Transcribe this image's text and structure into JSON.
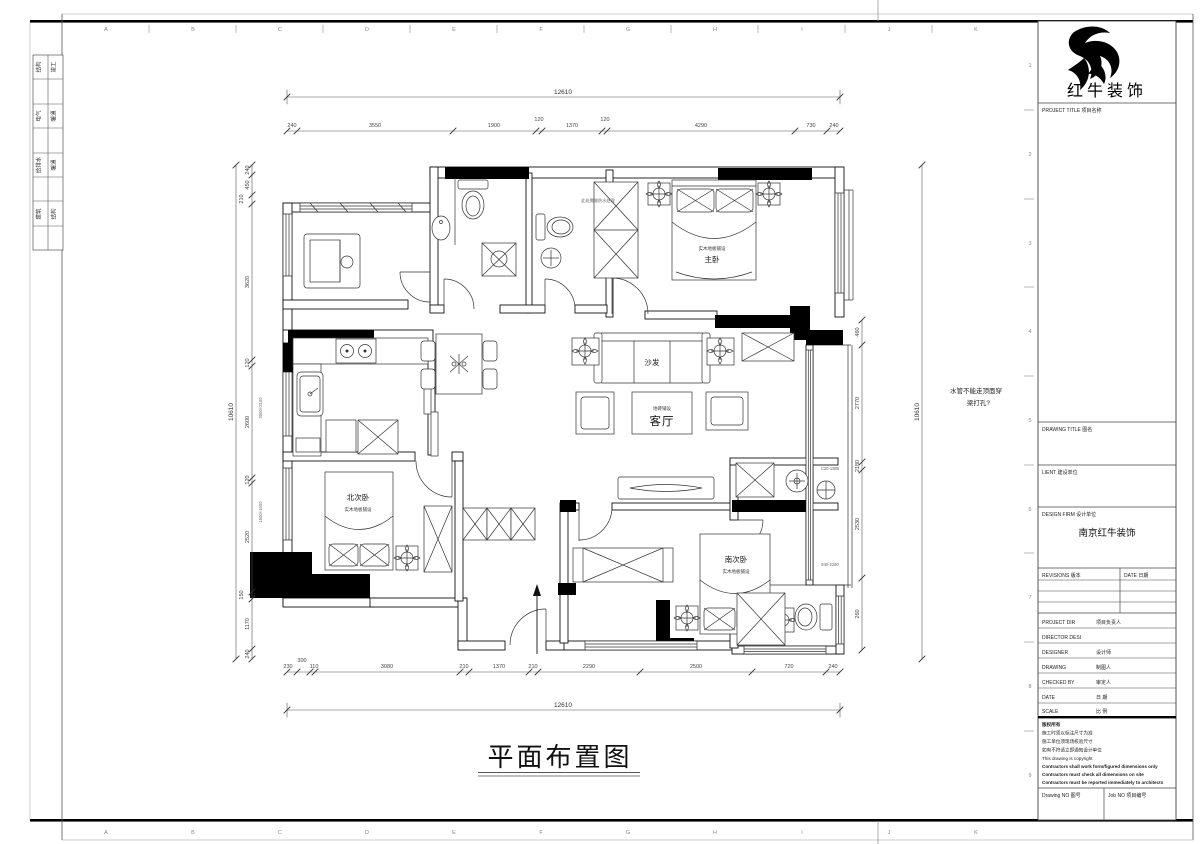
{
  "sheet": {
    "grid_letters": [
      "A",
      "B",
      "C",
      "D",
      "E",
      "F",
      "G",
      "H",
      "I",
      "J",
      "K"
    ],
    "grid_numbers": [
      "1",
      "2",
      "3",
      "4",
      "5",
      "6",
      "7",
      "8",
      "9"
    ],
    "signoff_rows": [
      {
        "a": "结构",
        "b": "竣工"
      },
      {
        "a": "电气",
        "b": "暖通"
      },
      {
        "a": "给排水",
        "b": "暖通"
      },
      {
        "a": "建筑",
        "b": "结构"
      }
    ]
  },
  "plan": {
    "title": "平面布置图",
    "note_line1": "水管不能走顶面穿",
    "note_line2": "梁打孔?",
    "waterproof_note": "此处需做防水处理",
    "rooms": {
      "living": "客厅",
      "living_sub": "地砖铺设",
      "sofa": "沙发",
      "master": "主卧",
      "master_sub": "实木地板铺设",
      "north": "北次卧",
      "north_sub": "实木地板铺设",
      "south": "南次卧",
      "south_sub": "实木地板铺设"
    },
    "window_tags": [
      "2000×2100",
      "1500×1500",
      "C20-1985",
      "940-2290"
    ],
    "dims": {
      "top_total": "12610",
      "bottom_total": "12610",
      "left_total": "10610",
      "right_total": "10610",
      "top": [
        "240",
        "3550",
        "1900",
        "120",
        "1370",
        "120",
        "4290",
        "730",
        "240"
      ],
      "bottom": [
        "230",
        "300",
        "110",
        "3080",
        "210",
        "1370",
        "210",
        "2290",
        "2500",
        "720",
        "240"
      ],
      "left": [
        "240",
        "450",
        "210",
        "3620",
        "120",
        "2600",
        "120",
        "2520",
        "150",
        "1170",
        "240"
      ],
      "right": [
        "460",
        "2770",
        "2180",
        "2530",
        "260"
      ]
    }
  },
  "titleblock": {
    "brand": "红牛装饰",
    "project_title": "PROJECT TITLE  项目名称",
    "drawing_title": "DRAWING TITLE  图名",
    "client": "LIENT  建设单位",
    "design_firm_label": "DESIGN FIRM  设计单位",
    "design_firm": "南京红牛装饰",
    "revisions": "REVISIONS  版本",
    "date_col": "DATE  日期",
    "rows": [
      {
        "en": "PROJECT DIR",
        "cn": "项目负责人"
      },
      {
        "en": "DIRECTOR DESI",
        "cn": ""
      },
      {
        "en": "DESIGNER",
        "cn": "设计师"
      },
      {
        "en": "DRAWING",
        "cn": "制图人"
      },
      {
        "en": "CHECKED BY",
        "cn": "审定人"
      },
      {
        "en": "DATE",
        "cn": "日 期"
      },
      {
        "en": "SCALE",
        "cn": "比 例"
      }
    ],
    "copyright": [
      "版权所有",
      "施工时须以标注尺寸为准",
      "施工单位须现场校验尺寸",
      "如有不符请立即通知设计单位",
      "This drawing is copyright",
      "Contractors shall work form/figured dimensions only",
      "Contractors must check all dimensions on site",
      "Contractors must be reported immediately to architects"
    ],
    "drawing_no": "Drawing NO  图号",
    "job_no": "Job NO  项目编号"
  }
}
